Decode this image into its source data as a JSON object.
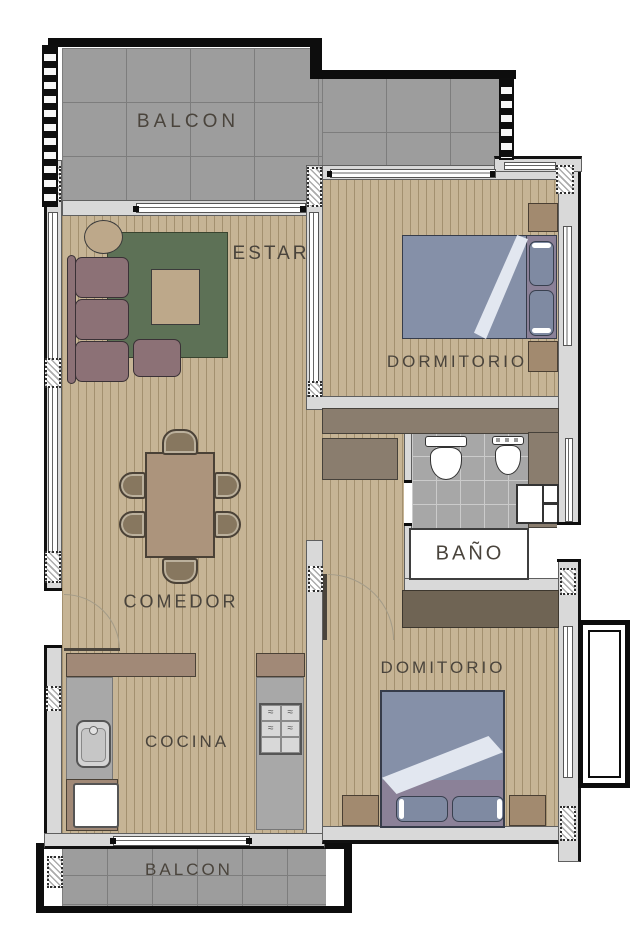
{
  "document": {
    "type_hint": "apartment floor plan drawing"
  },
  "rooms": {
    "balcony_top": {
      "label": "BALCON"
    },
    "living_room": {
      "label": "ESTAR"
    },
    "bedroom_main": {
      "label": "DORMITORIO"
    },
    "bathroom": {
      "label": "BAÑO"
    },
    "dining_room": {
      "label": "COMEDOR"
    },
    "kitchen": {
      "label": "COCINA"
    },
    "bedroom_second": {
      "label": "DOMITORIO"
    },
    "balcony_bottom": {
      "label": "BALCON"
    }
  },
  "colors": {
    "wood": "#c6b495",
    "wood_line": "#a3906f",
    "tile": "#9d9d9d",
    "tile_line": "#7d7d7d",
    "bath_tile": "#a7a7a7",
    "bath_tile_line": "#cbcbcb",
    "wall": "#d9d9d9",
    "wall_edge": "#5f5f5f",
    "outline": "#0d0d0d",
    "closet": "#8a7d6e",
    "wardrobe": "#6f6454",
    "rug": "#5d7156",
    "sofa": "#8c7176",
    "furniture_tan": "#bda88a",
    "dining_table": "#ac947c",
    "chair": "#87775f",
    "bed": "#8590a8",
    "bed_fold": "#e2e7f0",
    "mattress": "#8b8198",
    "pillow": "#7f8aa2",
    "nightstand": "#a28a6f",
    "counter": "#a8a8a8",
    "cabinet": "#a18977",
    "fixture_white": "#ffffff",
    "label_text": "#4a443c"
  }
}
